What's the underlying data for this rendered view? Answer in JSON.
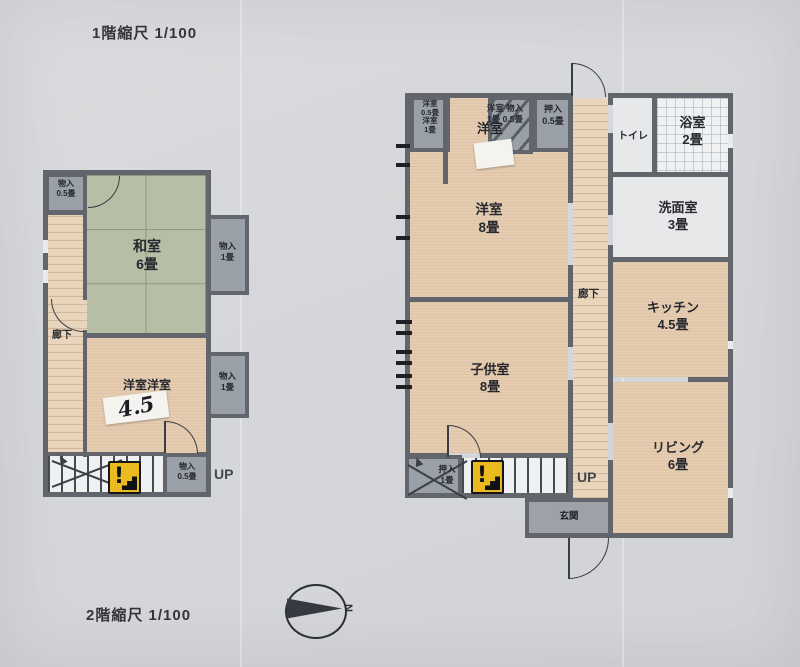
{
  "titles": {
    "top": "1階縮尺 1/100",
    "bottom": "2階縮尺 1/100"
  },
  "compass": {
    "north": "N"
  },
  "palette": {
    "paper": "#d6d7da",
    "wall": "#63656d",
    "room_beige": "#e5ccb0",
    "tatami_green": "#b6bfa6",
    "closet_gray": "#9aa0a7",
    "wet_area_gray": "#e7e8ea",
    "warning_yellow": "#eaba1f"
  },
  "left_plan": {
    "closet_top_left": {
      "label": "物入",
      "size": "0.5畳"
    },
    "washitsu": {
      "label": "和室",
      "size": "6畳"
    },
    "closet_right_upper": {
      "label": "物入",
      "size": "1畳"
    },
    "corridor": "廊下",
    "youshitsu": {
      "label": "洋室洋室",
      "sticker_size": "4.5"
    },
    "closet_right_lower": {
      "label": "物入",
      "size": "1畳"
    },
    "closet_bottom": {
      "label": "物入",
      "size": "0.5畳"
    },
    "up": "UP",
    "warning": "!"
  },
  "right_plan": {
    "closet_a": {
      "line1": "洋室",
      "line2": "0.5畳",
      "line3": "洋室",
      "line4": "1畳"
    },
    "closet_hatched": {
      "line1": "洋室 物入",
      "line2": "1畳 0.5畳"
    },
    "youshitsu_note": "洋室",
    "oshiire_top": {
      "label": "押入",
      "size": "0.5畳"
    },
    "youshitsu": {
      "label": "洋室",
      "size": "8畳"
    },
    "toilet": "トイレ",
    "bath": {
      "label": "浴室",
      "size": "2畳"
    },
    "washroom": {
      "label": "洗面室",
      "size": "3畳"
    },
    "corridor": "廊下",
    "kids_room": {
      "label": "子供室",
      "size": "8畳"
    },
    "kitchen": {
      "label": "キッチン",
      "size": "4.5畳"
    },
    "living": {
      "label": "リビング",
      "size": "6畳"
    },
    "oshiire_bottom": {
      "label": "押入",
      "size": "1畳"
    },
    "up": "UP",
    "entrance": "玄関",
    "warning": "!"
  }
}
